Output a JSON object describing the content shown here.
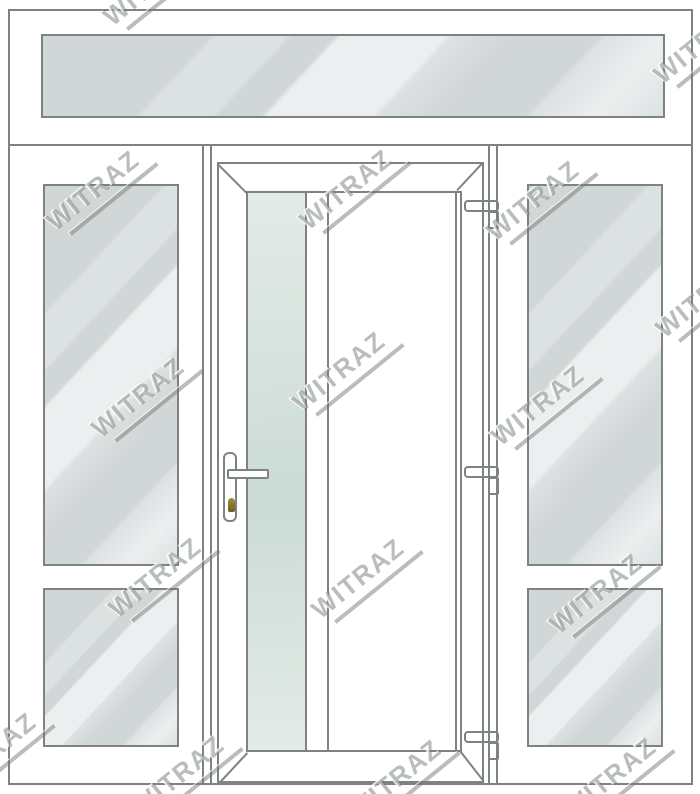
{
  "watermark": {
    "text": "WITRAZ",
    "color": "rgba(118,124,124,0.5)",
    "positions": [
      {
        "x": 152,
        "y": -12
      },
      {
        "x": 702,
        "y": 46
      },
      {
        "x": 95,
        "y": 193
      },
      {
        "x": 348,
        "y": 192
      },
      {
        "x": 535,
        "y": 203
      },
      {
        "x": 704,
        "y": 300
      },
      {
        "x": 140,
        "y": 400
      },
      {
        "x": 341,
        "y": 374
      },
      {
        "x": 540,
        "y": 408
      },
      {
        "x": 157,
        "y": 580
      },
      {
        "x": 360,
        "y": 581
      },
      {
        "x": 598,
        "y": 596
      },
      {
        "x": -8,
        "y": 755
      },
      {
        "x": 180,
        "y": 778
      },
      {
        "x": 397,
        "y": 782
      },
      {
        "x": 612,
        "y": 780
      }
    ]
  },
  "door_unit": {
    "transom": {
      "pane_count": 1
    },
    "left_sidelight": {
      "pane_count": 2
    },
    "door": {
      "hinge_count": 3,
      "has_lever_handle": true,
      "has_keyhole": true,
      "glass_strip": true
    },
    "right_sidelight": {
      "pane_count": 2
    }
  },
  "colors": {
    "frame_line": "#7d8284",
    "glass_base": "#d1d6d6",
    "glass_mid": "#dce1e1",
    "glass_highlight": "#ecefef",
    "door_glass_top": "#e3ebe7",
    "door_glass_bottom": "#ccdbd5",
    "keyhole_light": "#a38d3f",
    "keyhole_dark": "#6e5b20"
  }
}
